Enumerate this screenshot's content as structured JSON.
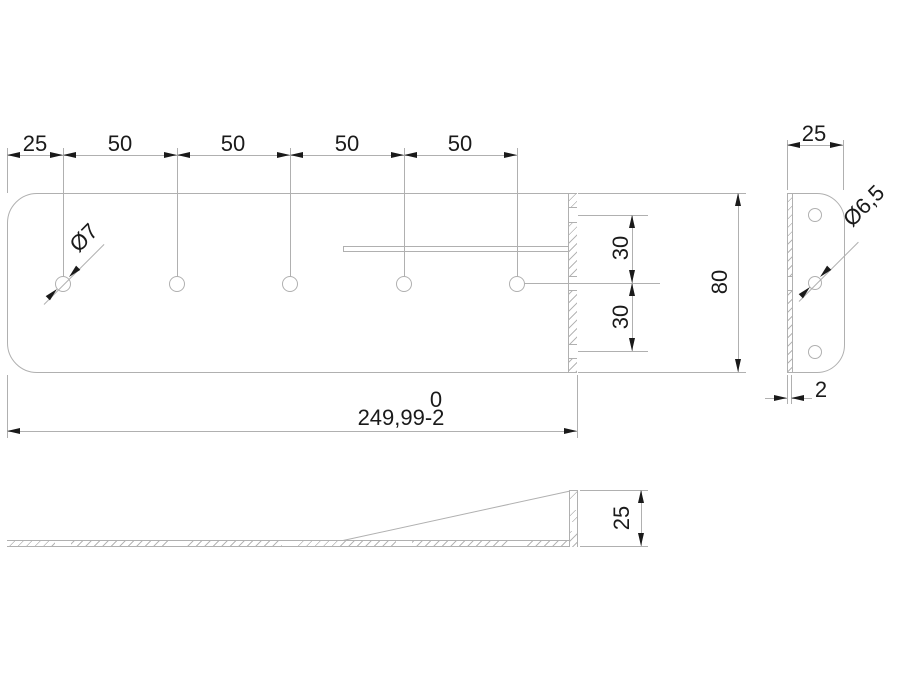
{
  "drawing": {
    "front_view": {
      "pitch_dims": [
        "25",
        "50",
        "50",
        "50",
        "50"
      ],
      "hole_callout": "Ø7",
      "height_dim": "80",
      "hole_spacing_dims": [
        "30",
        "30"
      ],
      "length_tolerance_upper": "0",
      "length_dim": "249,99-2"
    },
    "side_view": {
      "width_dim": "25",
      "hole_callout": "Ø6,5",
      "thickness_dim": "2"
    },
    "profile_view": {
      "flange_height_dim": "25"
    },
    "colors": {
      "line": "#b0b0b0",
      "ink": "#1a1a1a",
      "background": "#ffffff"
    }
  }
}
